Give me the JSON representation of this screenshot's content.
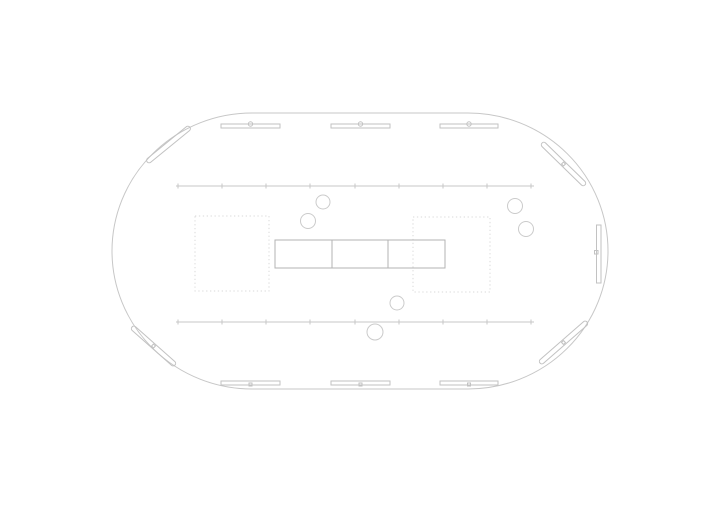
{
  "canvas": {
    "width": 720,
    "height": 509,
    "background": "#ffffff"
  },
  "palette": {
    "line": "#c7c7c7",
    "panel": "#c2c2c2",
    "dashed": "#d9d9d9",
    "table": "#b3b3b3",
    "circle": "#cbcbcb"
  },
  "floor_plan": {
    "shapes": [
      {
        "name": "building-outline",
        "type": "rect",
        "x": 112,
        "y": 113,
        "w": 496,
        "h": 276,
        "rx": 140,
        "color": "line"
      },
      {
        "name": "top-wall-panel-left",
        "type": "rect",
        "x": 221,
        "y": 124,
        "w": 59,
        "h": 4,
        "color": "panel"
      },
      {
        "name": "top-wall-panel-left-marker",
        "type": "circle",
        "cx": 250.5,
        "cy": 124,
        "r": 2.2,
        "color": "panel"
      },
      {
        "name": "top-wall-panel-center",
        "type": "rect",
        "x": 331,
        "y": 124,
        "w": 59,
        "h": 4,
        "color": "panel"
      },
      {
        "name": "top-wall-panel-center-marker",
        "type": "circle",
        "cx": 360.5,
        "cy": 124,
        "r": 2.2,
        "color": "panel"
      },
      {
        "name": "top-wall-panel-right",
        "type": "rect",
        "x": 440,
        "y": 124,
        "w": 58,
        "h": 4,
        "color": "panel"
      },
      {
        "name": "top-wall-panel-right-marker",
        "type": "circle",
        "cx": 469,
        "cy": 124,
        "r": 2.2,
        "color": "panel"
      },
      {
        "name": "bottom-wall-panel-left",
        "type": "rect",
        "x": 221,
        "y": 381,
        "w": 59,
        "h": 4,
        "color": "panel"
      },
      {
        "name": "bottom-wall-panel-left-marker",
        "type": "rect",
        "x": 249,
        "y": 383,
        "w": 3,
        "h": 3,
        "color": "panel"
      },
      {
        "name": "bottom-wall-panel-center",
        "type": "rect",
        "x": 331,
        "y": 381,
        "w": 59,
        "h": 4,
        "color": "panel"
      },
      {
        "name": "bottom-wall-panel-center-marker",
        "type": "rect",
        "x": 359,
        "y": 383,
        "w": 3,
        "h": 3,
        "color": "panel"
      },
      {
        "name": "bottom-wall-panel-right",
        "type": "rect",
        "x": 440,
        "y": 381,
        "w": 58,
        "h": 4,
        "color": "panel"
      },
      {
        "name": "bottom-wall-panel-right-marker",
        "type": "rect",
        "x": 467.5,
        "y": 383,
        "w": 3,
        "h": 3,
        "color": "panel"
      },
      {
        "name": "right-wall-panel",
        "type": "rect",
        "x": 596.5,
        "y": 225,
        "w": 4.5,
        "h": 58,
        "color": "panel"
      },
      {
        "name": "right-wall-panel-marker",
        "type": "rect",
        "x": 594.5,
        "y": 250.5,
        "w": 3.5,
        "h": 3.5,
        "color": "panel"
      },
      {
        "name": "corner-panel-top-left",
        "type": "rect",
        "x": 141,
        "y": 142,
        "w": 55,
        "h": 5,
        "rx": 2.5,
        "rotate": -39.2,
        "color": "panel"
      },
      {
        "name": "corner-panel-top-right",
        "type": "rect",
        "x": 533.5,
        "y": 161.5,
        "w": 60,
        "h": 5,
        "rx": 2.5,
        "rotate": 44.3,
        "color": "panel"
      },
      {
        "name": "corner-panel-top-right-marker",
        "type": "rect",
        "x": 562.1,
        "y": 162.6,
        "w": 2.8,
        "h": 2.8,
        "rotate": 44.3,
        "color": "panel"
      },
      {
        "name": "corner-panel-bottom-left",
        "type": "rect",
        "x": 124.8,
        "y": 343.5,
        "w": 57.4,
        "h": 5,
        "rx": 2.5,
        "rotate": 41.5,
        "color": "panel"
      },
      {
        "name": "corner-panel-bottom-left-marker",
        "type": "rect",
        "x": 152.1,
        "y": 344.6,
        "w": 2.8,
        "h": 2.8,
        "rotate": 41.5,
        "color": "panel"
      },
      {
        "name": "corner-panel-bottom-right",
        "type": "rect",
        "x": 532.3,
        "y": 340,
        "w": 62.4,
        "h": 5,
        "rx": 2.5,
        "rotate": -41.1,
        "color": "panel"
      },
      {
        "name": "corner-panel-bottom-right-marker",
        "type": "rect",
        "x": 562.1,
        "y": 341.1,
        "w": 2.8,
        "h": 2.8,
        "rotate": -41.1,
        "color": "panel"
      },
      {
        "name": "upper-rail-line",
        "type": "tickline",
        "y": 186,
        "x1": 176,
        "x2": 534,
        "tickh": 5,
        "ticks": [
          178,
          222,
          266,
          310,
          355,
          399,
          443,
          487,
          531
        ],
        "color": "line"
      },
      {
        "name": "lower-rail-line",
        "type": "tickline",
        "y": 322,
        "x1": 176,
        "x2": 534,
        "tickh": 5,
        "ticks": [
          178,
          222,
          266,
          310,
          355,
          399,
          443,
          487,
          531
        ],
        "color": "line"
      },
      {
        "name": "dashed-zone-left",
        "type": "rect",
        "x": 195,
        "y": 216,
        "w": 74,
        "h": 75,
        "dash": "1.3 2.6",
        "color": "dashed"
      },
      {
        "name": "dashed-zone-right",
        "type": "rect",
        "x": 413,
        "y": 217,
        "w": 77,
        "h": 75,
        "dash": "1.3 2.6",
        "color": "dashed"
      },
      {
        "name": "center-table",
        "type": "rect",
        "x": 275,
        "y": 240,
        "w": 170,
        "h": 28,
        "color": "table"
      },
      {
        "name": "center-table-divider-1",
        "type": "line",
        "x1": 332,
        "y1": 240,
        "x2": 332,
        "y2": 268,
        "color": "table"
      },
      {
        "name": "center-table-divider-2",
        "type": "line",
        "x1": 388,
        "y1": 240,
        "x2": 388,
        "y2": 268,
        "color": "table"
      },
      {
        "name": "circle-seat-1",
        "type": "circle",
        "cx": 323,
        "cy": 202,
        "r": 7,
        "color": "circle"
      },
      {
        "name": "circle-seat-2",
        "type": "circle",
        "cx": 308,
        "cy": 221,
        "r": 7.5,
        "color": "circle"
      },
      {
        "name": "circle-seat-3",
        "type": "circle",
        "cx": 515,
        "cy": 206,
        "r": 7.5,
        "color": "circle"
      },
      {
        "name": "circle-seat-4",
        "type": "circle",
        "cx": 526,
        "cy": 229,
        "r": 7.5,
        "color": "circle"
      },
      {
        "name": "circle-seat-5",
        "type": "circle",
        "cx": 397,
        "cy": 303,
        "r": 7,
        "color": "circle"
      },
      {
        "name": "circle-seat-6",
        "type": "circle",
        "cx": 375,
        "cy": 332,
        "r": 8,
        "color": "circle"
      }
    ]
  }
}
